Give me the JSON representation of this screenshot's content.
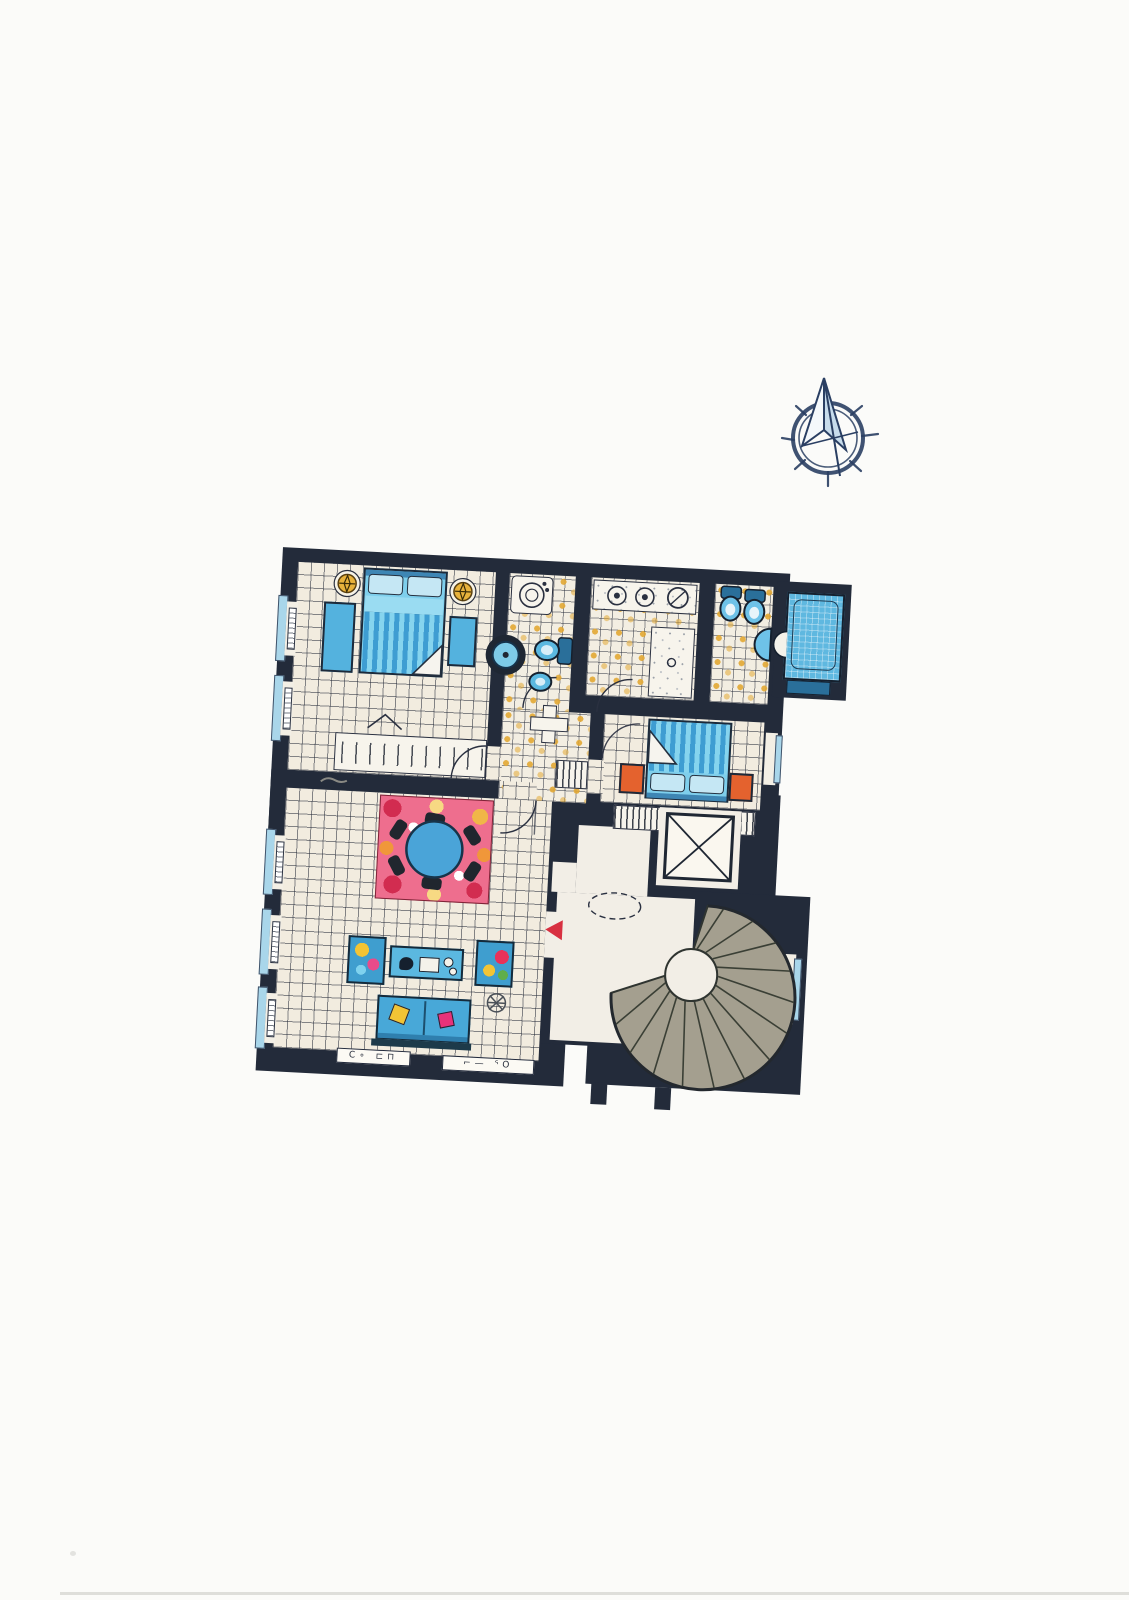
{
  "page": {
    "background": "#fbfbf9",
    "kind": "scanned hand-drawn apartment floor plan, no printed text"
  },
  "compass": {
    "name": "compass-rose",
    "ink_color": "#2a3f63",
    "needle_fill": "#cfe2ef",
    "points": 8
  },
  "plan": {
    "rotation_deg": 3,
    "colors": {
      "wall": "#232b3a",
      "tile_floor": "#f2ecdf",
      "tile_line": "#262c3a",
      "bath_dot": "#e2a834",
      "furniture_blue": "#54b2de",
      "duvet_stripe_dark": "#3e9dd2",
      "duvet_stripe_light": "#86d4ee",
      "nightstand_orange": "#e4622e",
      "rug_pink": "#ee6e8e",
      "rug_red": "#d22c50",
      "rug_gold": "#f0b648",
      "stair_tread": "#a49f8f",
      "window_sill": "#a9d6ea",
      "lamp_gold": "#e8b23c",
      "entry_arrow_red": "#d83040",
      "landing_floor": "#f2eee6"
    },
    "rooms": [
      {
        "name": "bedroom-1",
        "furniture": [
          "double-bed",
          "nightstand-left",
          "nightstand-right",
          "bedside-lamp-left",
          "bedside-lamp-right",
          "dresser",
          "wall-lamp"
        ]
      },
      {
        "name": "wc-shower-room",
        "furniture": [
          "washing-machine",
          "pedestal-basin",
          "toilet",
          "bidet"
        ]
      },
      {
        "name": "bathroom",
        "furniture": [
          "vanity-counter",
          "twin-sinks",
          "mirror",
          "shower-tray"
        ]
      },
      {
        "name": "wc-2",
        "furniture": [
          "wall-toilet-1",
          "wall-toilet-2",
          "corner-sink"
        ]
      },
      {
        "name": "bath-niche",
        "furniture": [
          "bathtub",
          "wall-sink"
        ]
      },
      {
        "name": "bedroom-2",
        "furniture": [
          "double-bed",
          "nightstand-left",
          "nightstand-right",
          "wardrobe"
        ]
      },
      {
        "name": "living-dining-room",
        "furniture": [
          "round-table",
          "dining-chairs-x6",
          "floral-rug",
          "armchair-left",
          "armchair-right",
          "media-console",
          "sofa",
          "ceiling-fan-symbol"
        ]
      },
      {
        "name": "hallway",
        "furniture": [
          "column",
          "shelf"
        ]
      },
      {
        "name": "landing",
        "furniture": [
          "entry-arrow",
          "door-swing-dashed"
        ]
      },
      {
        "name": "elevator-shaft",
        "furniture": [
          "shaft-x-symbol"
        ]
      },
      {
        "name": "spiral-staircase",
        "furniture": []
      }
    ],
    "windows": {
      "left_wall_bays": 5,
      "right_wall_bays": 2
    },
    "annotations": {
      "left_marks": "C∘  ⊏⊓",
      "right_marks": "⌐—  ᕐO"
    }
  }
}
